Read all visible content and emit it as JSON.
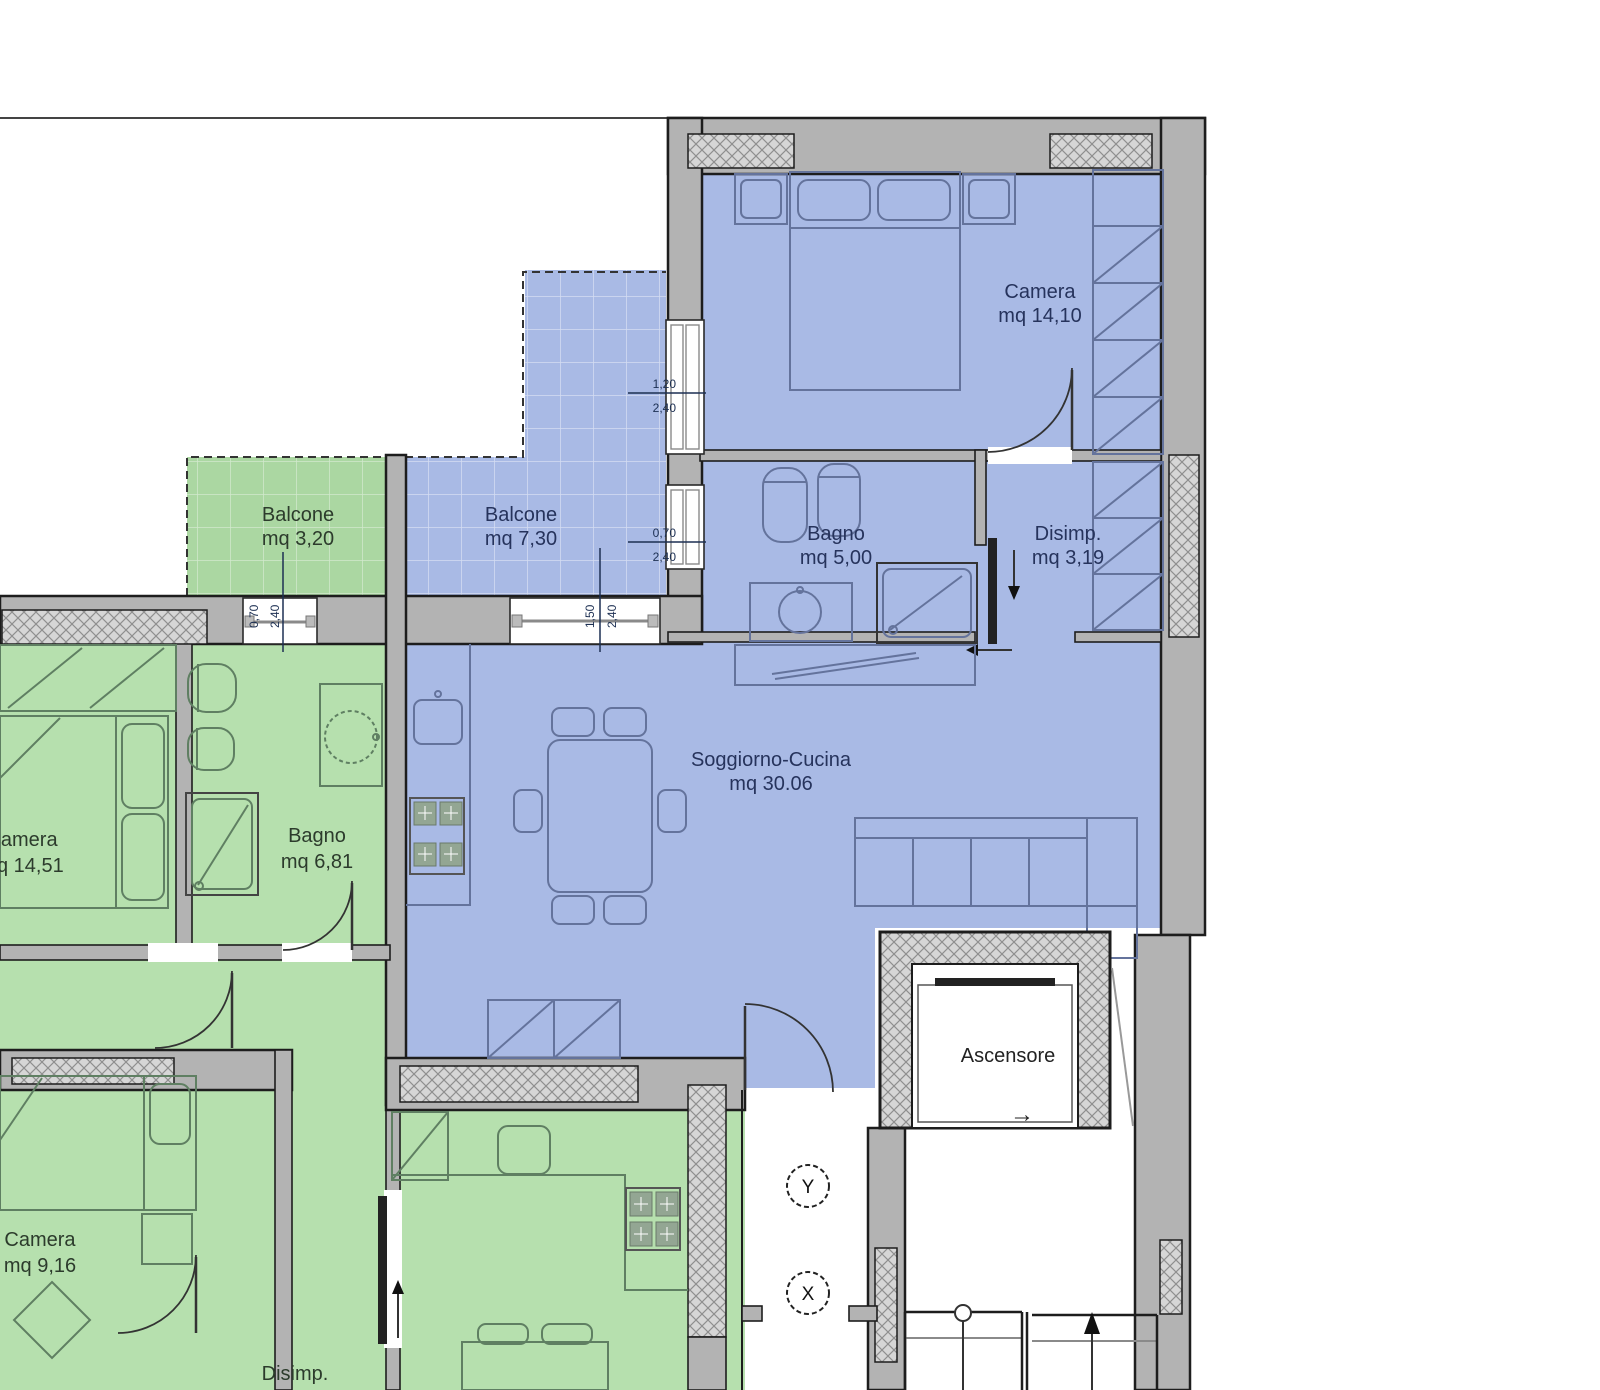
{
  "rooms": {
    "camera_blue": {
      "label": "Camera",
      "area": "mq 14,10"
    },
    "balcone_green": {
      "label": "Balcone",
      "area": "mq 3,20"
    },
    "balcone_blue": {
      "label": "Balcone",
      "area": "mq 7,30"
    },
    "bagno_blue": {
      "label": "Bagno",
      "area": "mq 5,00"
    },
    "disimp_blue": {
      "label": "Disimp.",
      "area": "mq 3,19"
    },
    "soggiorno": {
      "label": "Soggiorno-Cucina",
      "area": "mq 30.06"
    },
    "camera_green_1": {
      "label": "Camera",
      "area": "mq 14,51"
    },
    "bagno_green": {
      "label": "Bagno",
      "area": "mq 6,81"
    },
    "camera_green_2": {
      "label": "Camera",
      "area": "mq 9,16"
    },
    "disimp_green": {
      "label": "Disimp.",
      "area": "mq 9,76"
    },
    "ascensore": {
      "label": "Ascensore"
    }
  },
  "dimensions": {
    "camera_window": {
      "width": "1,20",
      "height": "2,40"
    },
    "bagno_window": {
      "width": "0,70",
      "height": "2,40"
    },
    "soggiorno_window": {
      "width": "1,50",
      "height": "2,40"
    },
    "balcone_green_window": {
      "width": "0,70",
      "height": "2,40"
    }
  },
  "markers": {
    "section_y": "Y",
    "section_x": "X",
    "elevator_arrow": "→"
  },
  "colors": {
    "apartment_blue": "#a9bae5",
    "apartment_green": "#b6e0ae",
    "balcony_green": "#abd7a2",
    "wall_gray": "#b3b3b3",
    "outline": "#1d1d1d",
    "label_blue": "#26335c",
    "label_green": "#2c3b2c"
  }
}
